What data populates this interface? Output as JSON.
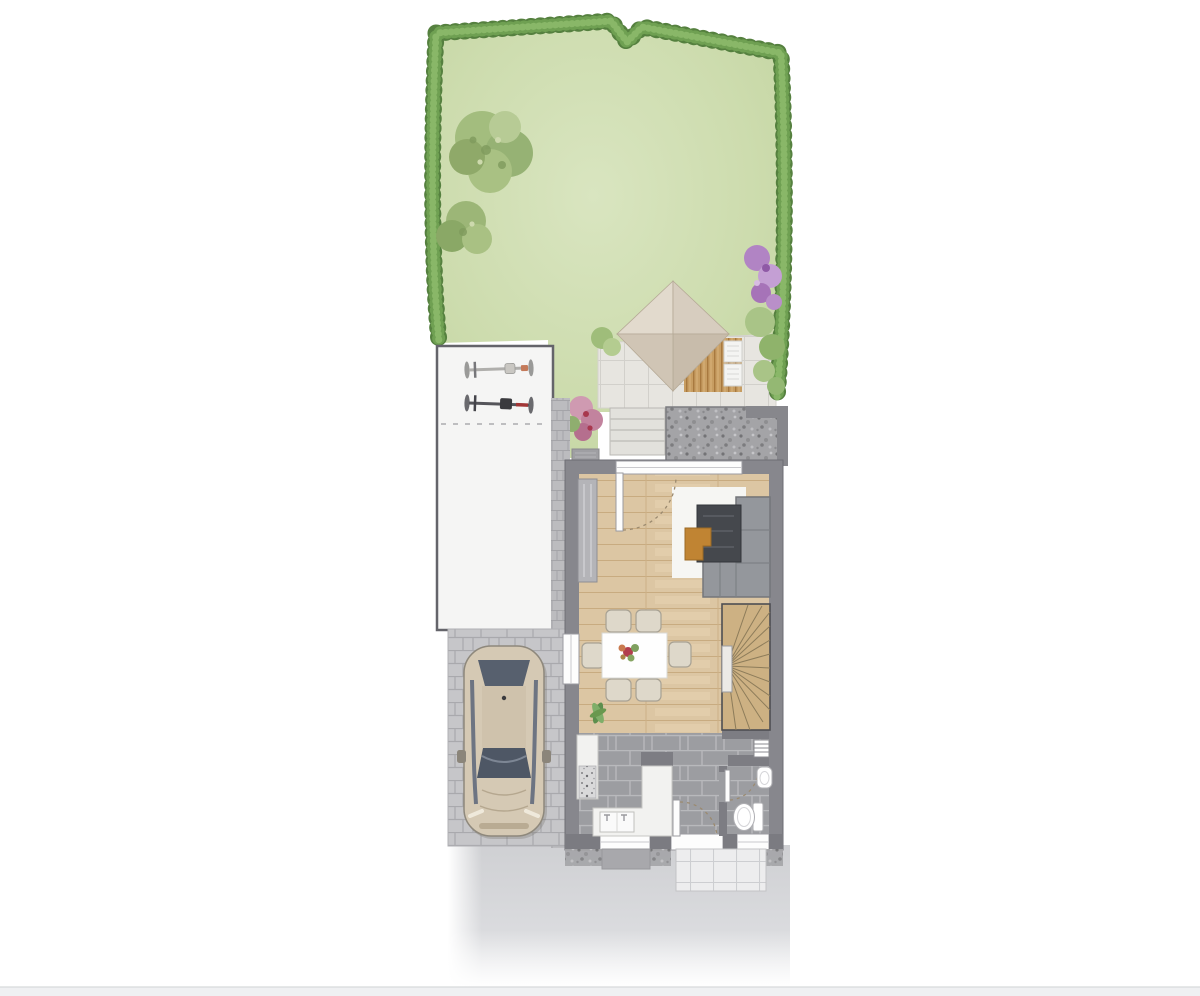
{
  "title": "site-and-ground-floor-plan-illustration",
  "palette": {
    "lawn_light": "#d7e4bd",
    "lawn_dark": "#c4d6a3",
    "hedge": "#55803f",
    "hedge_mid": "#6fa052",
    "hedge_light": "#8cb96a",
    "tree_foliage": "#a3bd7e",
    "flowers_purple": "#b184c4",
    "flowers_pink": "#cf9ab1",
    "patio_tile": "#e7e5e0",
    "pavilion_roof": "#d7cdbf",
    "deck_wood": "#c79d62",
    "gravel": "#a4a4a7",
    "shed": "#f5f5f4",
    "shed_border": "#64646a",
    "pavers": "#c6c6c9",
    "street": "#cfd0d3",
    "wall": "#87878d",
    "partition": "#7d7d83",
    "window": "#fdfdfd",
    "wood_floor": "#dcc6a3",
    "tile_floor": "#9c9da1",
    "rug": "#f6f6f3",
    "sofa": "#94979c",
    "coffee_table": "#45484d",
    "accent_orange": "#c08433",
    "dining_table": "#fefefe",
    "chair": "#ded8ca",
    "stair_wood": "#cdb183",
    "counter": "#f2f2f0",
    "sanitary": "#ffffff",
    "car_body": "#d5c9b4",
    "car_glass": "#57606e",
    "door_arc": "#9b8a6f"
  },
  "scene": {
    "garden": {
      "lawn": "lawn",
      "hedge": "boundary-hedge",
      "trees": [
        "large-tree",
        "small-tree"
      ],
      "shrubs": [
        "purple-hedge-flowers",
        "pink-shrub",
        "patio-bush",
        "side-bushes"
      ],
      "pavilion": {
        "roof": "pyramid-roof",
        "deck": "wood-deck",
        "loungers": 2
      },
      "patio": "tiled-patio",
      "steps_count": 4,
      "gravel_bed": "gravel-bed",
      "doormat": "garden-doormat"
    },
    "outbuilding": {
      "kind": "shed",
      "bicycles": 2
    },
    "driveway": {
      "surface": "block-pavers",
      "car_count": 1,
      "path": "cobble-path"
    },
    "street": "front-pavement",
    "house": {
      "rooms": [
        "living-room",
        "dining-area",
        "kitchen",
        "hallway",
        "wc",
        "staircase"
      ],
      "living_room": [
        "wardrobe",
        "rug",
        "corner-sofa",
        "coffee-table",
        "orange-side-table",
        "entry-door"
      ],
      "dining_area": {
        "table": 1,
        "chairs": 6,
        "plant": 1
      },
      "kitchen": [
        "tall-unit-with-cooktop",
        "l-counter",
        "sink"
      ],
      "wc": [
        "toilet",
        "hand-basin"
      ],
      "hallway": [
        "front-door",
        "radiator"
      ],
      "windows": [
        "top-glazing",
        "left-window",
        "kitchen-window",
        "wc-window"
      ],
      "outside": [
        "gravel-strip",
        "entry-mat",
        "walkway-tiles"
      ]
    }
  }
}
